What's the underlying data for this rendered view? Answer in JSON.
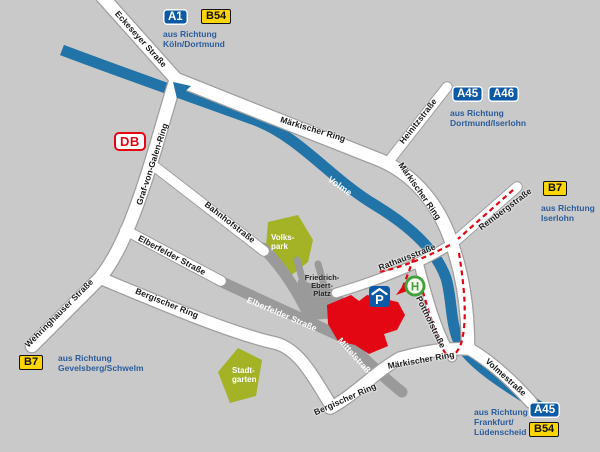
{
  "map_type": "city-access-map",
  "colors": {
    "background": "#c9c9c9",
    "road": "#ffffff",
    "road_casing": "#9f9f9f",
    "pedestrian_road": "#9a9a9a",
    "river": "#2173a8",
    "park": "#a3b325",
    "building": "#e30613",
    "route_dash": "#e30613",
    "autobahn_sign": "#0c5aa5",
    "bundesstrasse_sign": "#fdd500",
    "direction_text": "#2b5c9c",
    "db_red": "#e30613",
    "stop_green": "#3fa03a"
  },
  "signs": {
    "a1": "A1",
    "b54_top": "B54",
    "a45_top": "A45",
    "a46": "A46",
    "b7_right": "B7",
    "b7_left": "B7",
    "a45_bottom": "A45",
    "b54_bottom": "B54"
  },
  "directions": {
    "koeln": [
      "aus Richtung",
      "Köln/Dortmund"
    ],
    "dortmund": [
      "aus Richtung",
      "Dortmund/Iserlohn"
    ],
    "iserlohn": [
      "aus Richtung",
      "Iserlohn"
    ],
    "gevelsberg": [
      "aus Richtung",
      "Gevelsberg/Schwelm"
    ],
    "frankfurt": [
      "aus Richtung",
      "Frankfurt/",
      "Lüdenscheid"
    ]
  },
  "streets": {
    "eckeseyer": "Eckeseyer Straße",
    "maerkischer_ring": "Märkischer Ring",
    "heinitz": "Heinitzstraße",
    "remberg": "Rembergstraße",
    "graf_von_galen": "Graf-von-Galen-Ring",
    "bahnhof": "Bahnhofstraße",
    "elberfelder": "Elberfelder Straße",
    "wehringhauser": "Wehringhauser Straße",
    "bergischer_ring": "Bergischer Ring",
    "mittel": "Mittelstraße",
    "volmestrasse": "Volmestraße",
    "rathausstrasse": "Rathausstraße",
    "potthof": "Potthofstraße"
  },
  "river": {
    "name": "Volme"
  },
  "places": {
    "friedrich_ebert_platz": [
      "Friedrich-",
      "Ebert-",
      "Platz"
    ],
    "volkspark": [
      "Volks-",
      "park"
    ],
    "stadtgarten": [
      "Stadt-",
      "garten"
    ]
  },
  "icons": {
    "db_logo": "DB",
    "parking": "P",
    "bus_stop": "H"
  }
}
